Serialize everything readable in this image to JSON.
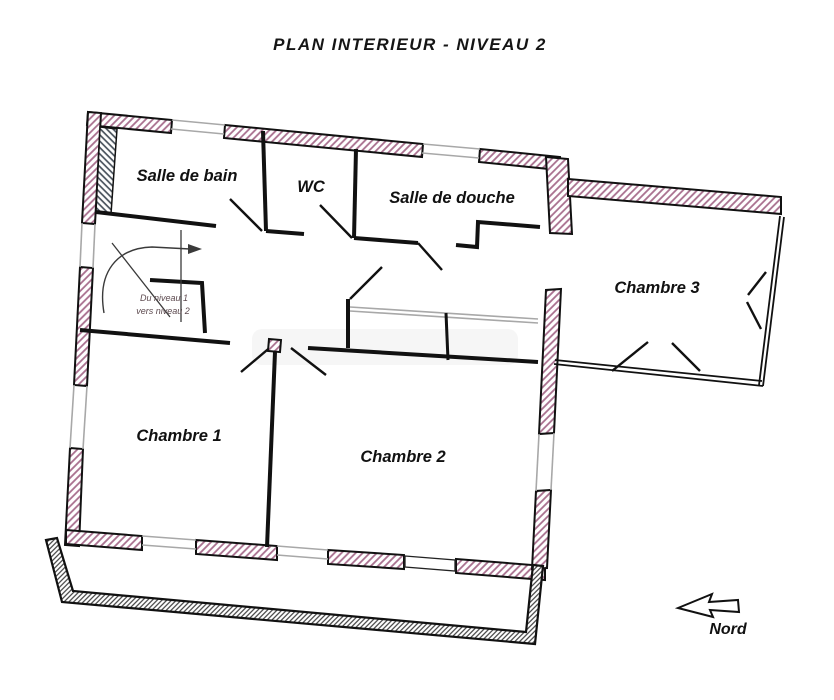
{
  "title": "PLAN INTERIEUR - NIVEAU 2",
  "rooms": {
    "salle_de_bain": {
      "label": "Salle de bain"
    },
    "wc": {
      "label": "WC"
    },
    "salle_de_douche": {
      "label": "Salle de douche"
    },
    "chambre_3": {
      "label": "Chambre 3"
    },
    "chambre_1": {
      "label": "Chambre 1"
    },
    "chambre_2": {
      "label": "Chambre 2"
    }
  },
  "stairs": {
    "line1": "Du niveau 1",
    "line2": "vers niveau 2"
  },
  "compass": {
    "label": "Nord"
  },
  "colors": {
    "wall_hatch": "#a86f8e",
    "inner_hatch": "#49525c",
    "balcony_hatch": "#2f2f2f",
    "outline": "#111111",
    "window_line": "#a8a8a8",
    "stair_text": "#5d4a4f"
  }
}
